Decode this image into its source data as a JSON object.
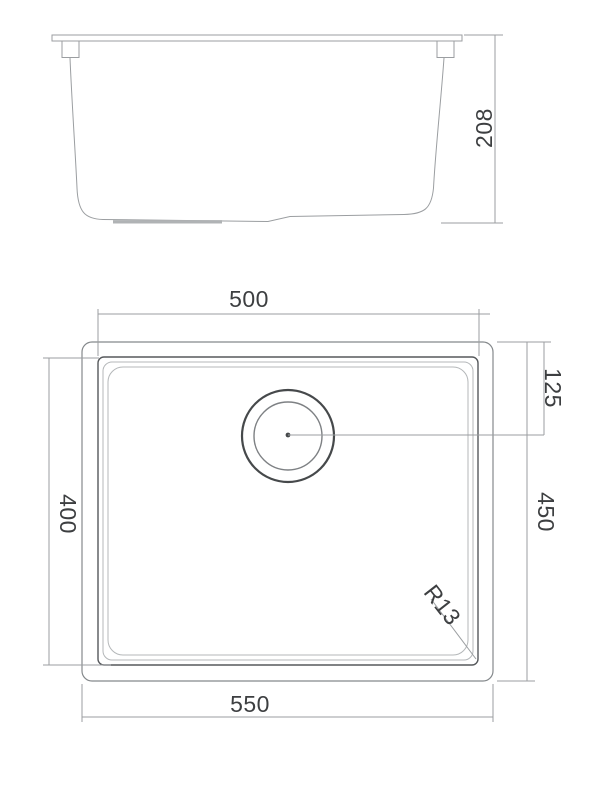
{
  "drawing": {
    "kind": "technical-dimension-drawing",
    "subject": "undermount-sink",
    "views": {
      "side_view": {
        "name": "side-elevation",
        "dimensions": {
          "height": "208"
        }
      },
      "plan_view": {
        "name": "top-plan",
        "dimensions": {
          "bowl_width": "500",
          "overall_width": "550",
          "bowl_length": "400",
          "overall_length": "450",
          "drain_center_offset": "125",
          "corner_radius": "R13"
        }
      }
    },
    "colors": {
      "background": "#ffffff",
      "line": "#9b9ea1",
      "line_medium": "#85898c",
      "line_dark": "#56595c",
      "line_light": "#b4b7b9",
      "drain_line": "#46494b",
      "dimension_text": "#3d3f41"
    }
  }
}
